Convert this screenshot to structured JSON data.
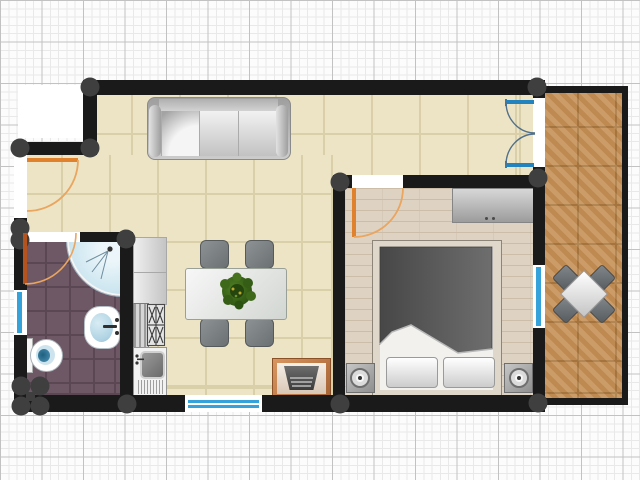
{
  "canvas": {
    "width_px": 640,
    "height_px": 480,
    "background": "graph-paper-grid"
  },
  "palette": {
    "paper": "#fcfcfc",
    "grid_fine": "#e9e9e9",
    "grid_major": "#c2c2c2",
    "wall": "#1a1a1a",
    "joint": "#3f3f3f",
    "white": "#ffffff",
    "living_floor": "#ece4c5",
    "living_grout": "#d9d0a9",
    "bath_floor": "#6e5866",
    "bath_grout": "#5b4754",
    "bedroom_floor": "#ded2c2",
    "bedroom_plank": "#ccbda9",
    "balcony_floor": "#c69157",
    "balcony_grout": "#a87941",
    "door_orange": "#e0812d",
    "door_arc": "#eaa55f",
    "door_brown": "#b4531d",
    "window_blue": "#35a3da",
    "french_blue": "#2383bf",
    "french_arc": "#52708a",
    "bed_frame": "#ded7ca",
    "duvet_dark": "#474747",
    "duvet_light": "#6e6e6e",
    "water_blue": "#cde6f0",
    "basin_blue": "#aed2e3",
    "toilet_spot": "#4f94b5",
    "plant_green": "#3e691b",
    "plant_dark": "#25450e",
    "plant_accent": "#b9a62b"
  },
  "plan": {
    "rooms": [
      {
        "name": "living-room",
        "floor": "ceramic-tile-beige"
      },
      {
        "name": "kitchen",
        "floor": "ceramic-tile-beige",
        "fixtures": [
          "counter-two-section",
          "cooktop-four-burner",
          "sink-with-drainboard"
        ]
      },
      {
        "name": "bathroom",
        "floor": "tile-purple",
        "fixtures": [
          "corner-shower",
          "washbasin-oval",
          "toilet"
        ]
      },
      {
        "name": "bedroom",
        "floor": "wood-plank-light",
        "furniture": [
          "double-bed",
          "pillow-x2",
          "nightstand-x2",
          "table-lamp-x2",
          "dresser"
        ]
      },
      {
        "name": "balcony",
        "floor": "wood-tile-terracotta",
        "furniture": [
          "bistro-table-square",
          "bistro-chair-x4"
        ]
      },
      {
        "name": "entry-alcove",
        "floor": "none"
      }
    ],
    "living_furniture": [
      "sofa-three-seat-with-chaise",
      "dining-table",
      "dining-chair-x4",
      "potted-plant-on-table",
      "pellet-stove-heater"
    ],
    "doors": [
      {
        "name": "entry-door",
        "type": "single-swing",
        "wall": "west",
        "color_key": "door_orange"
      },
      {
        "name": "bathroom-door",
        "type": "single-swing",
        "wall": "bathroom-north",
        "color_key": "door_brown"
      },
      {
        "name": "bedroom-door",
        "type": "single-swing",
        "wall": "bedroom-north",
        "color_key": "door_orange"
      },
      {
        "name": "balcony-french-door",
        "type": "double-swing",
        "wall": "east",
        "color_key": "french_blue"
      }
    ],
    "windows": [
      {
        "name": "bathroom-window",
        "wall": "west"
      },
      {
        "name": "living-room-window",
        "wall": "south"
      },
      {
        "name": "bedroom-window",
        "wall": "east"
      }
    ]
  }
}
